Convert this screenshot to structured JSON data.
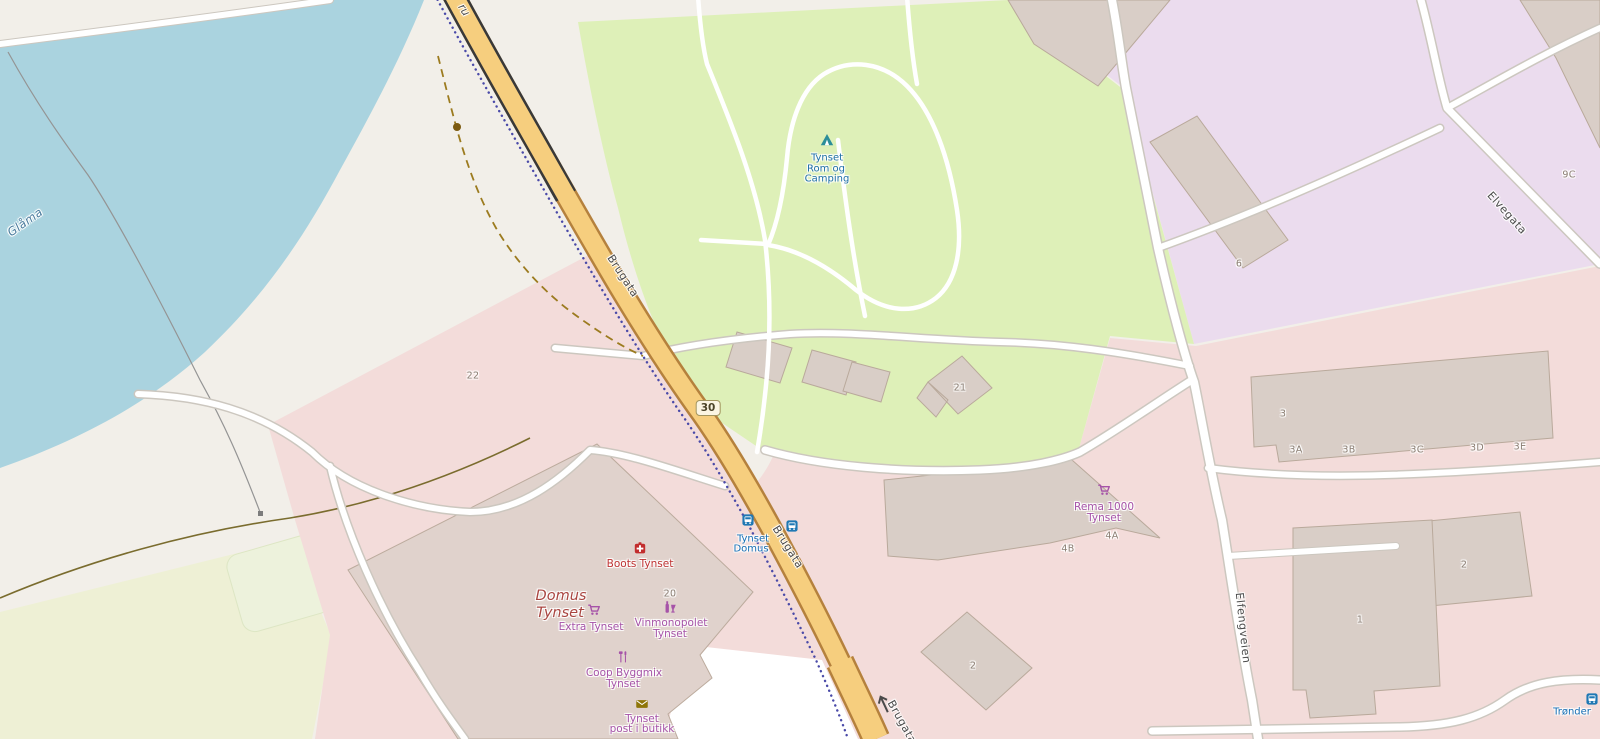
{
  "map": {
    "name": "map-canvas",
    "palette": {
      "land": "#f2efe9",
      "water": "#aad3df",
      "farmland": "#eef0d5",
      "camping_green": "#def0b8",
      "industrial": "#ebdcee",
      "residential_pink": "#f3dcda",
      "building": "#d9cec7",
      "building_large": "#e0d2cc",
      "road_fill": "#f6ce7e",
      "road_casing": "#b5813d",
      "bridge_casing": "#393939",
      "white_road": "#ffffff",
      "white_road_casing": "#ccc7bf",
      "footpath": "#4a4aa8",
      "track": "#9c7b1f",
      "fence": "#7a6c2e",
      "shop_purple": "#a653a8",
      "transit_blue": "#156fb5",
      "health_red": "#bf3333",
      "water_label": "#4a7b9d",
      "housenum_grey": "#8a7d72",
      "tent_teal": "#2b8e99",
      "mail_olive": "#8f7608",
      "bus_blue": "#1f78b4"
    },
    "route_shield": {
      "text": "30",
      "x": 708,
      "y": 408
    },
    "oneway_arrow": {
      "x": 884,
      "y": 704,
      "rot": -25
    },
    "labels": [
      {
        "id": "street-brugata-north",
        "text": "Brugata",
        "x": 623,
        "y": 276,
        "rot": 57,
        "cls": "street"
      },
      {
        "id": "street-brugata-mid",
        "text": "Brugata",
        "x": 788,
        "y": 547,
        "rot": 58,
        "cls": "street"
      },
      {
        "id": "street-brugata-south",
        "text": "Brugata",
        "x": 902,
        "y": 722,
        "rot": 61,
        "cls": "street"
      },
      {
        "id": "street-elvegata",
        "text": "Elvegata",
        "x": 1507,
        "y": 213,
        "rot": 48,
        "cls": "street"
      },
      {
        "id": "street-elfengveien",
        "text": "Elfengveien",
        "x": 1243,
        "y": 628,
        "rot": 84,
        "cls": "street"
      },
      {
        "id": "bridge-name-fragment",
        "text": "ru",
        "x": 464,
        "y": 10,
        "rot": 57,
        "cls": "street italic"
      },
      {
        "id": "river-name",
        "text": "Glåma",
        "x": 25,
        "y": 222,
        "rot": -35,
        "cls": "water"
      },
      {
        "id": "camping-name-1",
        "text": "Tynset",
        "x": 827,
        "y": 158,
        "rot": 0,
        "cls": "camp"
      },
      {
        "id": "camping-name-2",
        "text": "Rom og",
        "x": 826,
        "y": 169,
        "rot": 0,
        "cls": "camp"
      },
      {
        "id": "camping-name-3",
        "text": "Camping",
        "x": 827,
        "y": 179,
        "rot": 0,
        "cls": "camp"
      },
      {
        "id": "busstop-name-1",
        "text": "Tynset",
        "x": 753,
        "y": 539,
        "rot": 0,
        "cls": "transit"
      },
      {
        "id": "busstop-name-2",
        "text": "Domus",
        "x": 751,
        "y": 549,
        "rot": 0,
        "cls": "transit"
      },
      {
        "id": "busstop-tronder",
        "text": "Trønder",
        "x": 1572,
        "y": 712,
        "rot": 0,
        "cls": "transit"
      },
      {
        "id": "poi-boots",
        "text": "Boots Tynset",
        "x": 640,
        "y": 564,
        "rot": 0,
        "cls": "health"
      },
      {
        "id": "place-domus-1",
        "text": "Domus",
        "x": 561,
        "y": 596,
        "rot": 0,
        "cls": "place"
      },
      {
        "id": "place-domus-2",
        "text": "Tynset",
        "x": 560,
        "y": 613,
        "rot": 0,
        "cls": "place"
      },
      {
        "id": "poi-extra",
        "text": "Extra Tynset",
        "x": 591,
        "y": 627,
        "rot": 0,
        "cls": "shop"
      },
      {
        "id": "poi-vinmonopolet-1",
        "text": "Vinmonopolet",
        "x": 671,
        "y": 623,
        "rot": 0,
        "cls": "shop"
      },
      {
        "id": "poi-vinmonopolet-2",
        "text": "Tynset",
        "x": 670,
        "y": 634,
        "rot": 0,
        "cls": "shop"
      },
      {
        "id": "poi-coop-1",
        "text": "Coop Byggmix",
        "x": 624,
        "y": 673,
        "rot": 0,
        "cls": "shop"
      },
      {
        "id": "poi-coop-2",
        "text": "Tynset",
        "x": 623,
        "y": 684,
        "rot": 0,
        "cls": "shop"
      },
      {
        "id": "poi-post-1",
        "text": "Tynset",
        "x": 642,
        "y": 719,
        "rot": 0,
        "cls": "shop"
      },
      {
        "id": "poi-post-2",
        "text": "post i butikk",
        "x": 642,
        "y": 729,
        "rot": 0,
        "cls": "shop"
      },
      {
        "id": "poi-rema-1",
        "text": "Rema 1000",
        "x": 1104,
        "y": 507,
        "rot": 0,
        "cls": "shop"
      },
      {
        "id": "poi-rema-2",
        "text": "Tynset",
        "x": 1104,
        "y": 518,
        "rot": 0,
        "cls": "shop"
      },
      {
        "id": "housenum-22",
        "text": "22",
        "x": 473,
        "y": 376,
        "rot": 0,
        "cls": "housenum"
      },
      {
        "id": "housenum-21",
        "text": "21",
        "x": 960,
        "y": 388,
        "rot": 0,
        "cls": "housenum"
      },
      {
        "id": "housenum-20",
        "text": "20",
        "x": 670,
        "y": 594,
        "rot": 0,
        "cls": "housenum"
      },
      {
        "id": "housenum-6",
        "text": "6",
        "x": 1239,
        "y": 264,
        "rot": 0,
        "cls": "housenum"
      },
      {
        "id": "housenum-9c",
        "text": "9C",
        "x": 1569,
        "y": 175,
        "rot": 0,
        "cls": "housenum"
      },
      {
        "id": "housenum-3",
        "text": "3",
        "x": 1283,
        "y": 414,
        "rot": 0,
        "cls": "housenum"
      },
      {
        "id": "housenum-3a",
        "text": "3A",
        "x": 1296,
        "y": 450,
        "rot": 0,
        "cls": "housenum"
      },
      {
        "id": "housenum-3b",
        "text": "3B",
        "x": 1349,
        "y": 450,
        "rot": 0,
        "cls": "housenum"
      },
      {
        "id": "housenum-3c",
        "text": "3C",
        "x": 1417,
        "y": 450,
        "rot": 0,
        "cls": "housenum"
      },
      {
        "id": "housenum-3d",
        "text": "3D",
        "x": 1477,
        "y": 448,
        "rot": 0,
        "cls": "housenum"
      },
      {
        "id": "housenum-3e",
        "text": "3E",
        "x": 1520,
        "y": 447,
        "rot": 0,
        "cls": "housenum"
      },
      {
        "id": "housenum-4a",
        "text": "4A",
        "x": 1112,
        "y": 536,
        "rot": 0,
        "cls": "housenum"
      },
      {
        "id": "housenum-4b",
        "text": "4B",
        "x": 1068,
        "y": 549,
        "rot": 0,
        "cls": "housenum"
      },
      {
        "id": "housenum-2a",
        "text": "2",
        "x": 973,
        "y": 666,
        "rot": 0,
        "cls": "housenum"
      },
      {
        "id": "housenum-1",
        "text": "1",
        "x": 1360,
        "y": 620,
        "rot": 0,
        "cls": "housenum"
      },
      {
        "id": "housenum-2b",
        "text": "2",
        "x": 1464,
        "y": 565,
        "rot": 0,
        "cls": "housenum"
      }
    ],
    "icons": [
      {
        "id": "camping-tent",
        "icon": "tent-icon",
        "x": 827,
        "y": 140,
        "size": 14
      },
      {
        "id": "boots-pharmacy",
        "icon": "pharmacy-icon",
        "x": 640,
        "y": 548,
        "size": 13
      },
      {
        "id": "extra-cart",
        "icon": "cart-icon",
        "x": 594,
        "y": 610,
        "size": 13
      },
      {
        "id": "vinmonopolet",
        "icon": "wine-icon",
        "x": 670,
        "y": 607,
        "size": 13
      },
      {
        "id": "coop-diy",
        "icon": "diy-icon",
        "x": 623,
        "y": 657,
        "size": 13
      },
      {
        "id": "post-mail",
        "icon": "mail-icon",
        "x": 642,
        "y": 704,
        "size": 13
      },
      {
        "id": "rema-cart",
        "icon": "cart-icon",
        "x": 1104,
        "y": 490,
        "size": 13
      },
      {
        "id": "busstop-west",
        "icon": "bus-icon",
        "x": 748,
        "y": 520,
        "size": 12
      },
      {
        "id": "busstop-east",
        "icon": "bus-icon",
        "x": 792,
        "y": 526,
        "size": 12
      },
      {
        "id": "busstop-tronder",
        "icon": "bus-icon",
        "x": 1592,
        "y": 699,
        "size": 12
      }
    ]
  }
}
